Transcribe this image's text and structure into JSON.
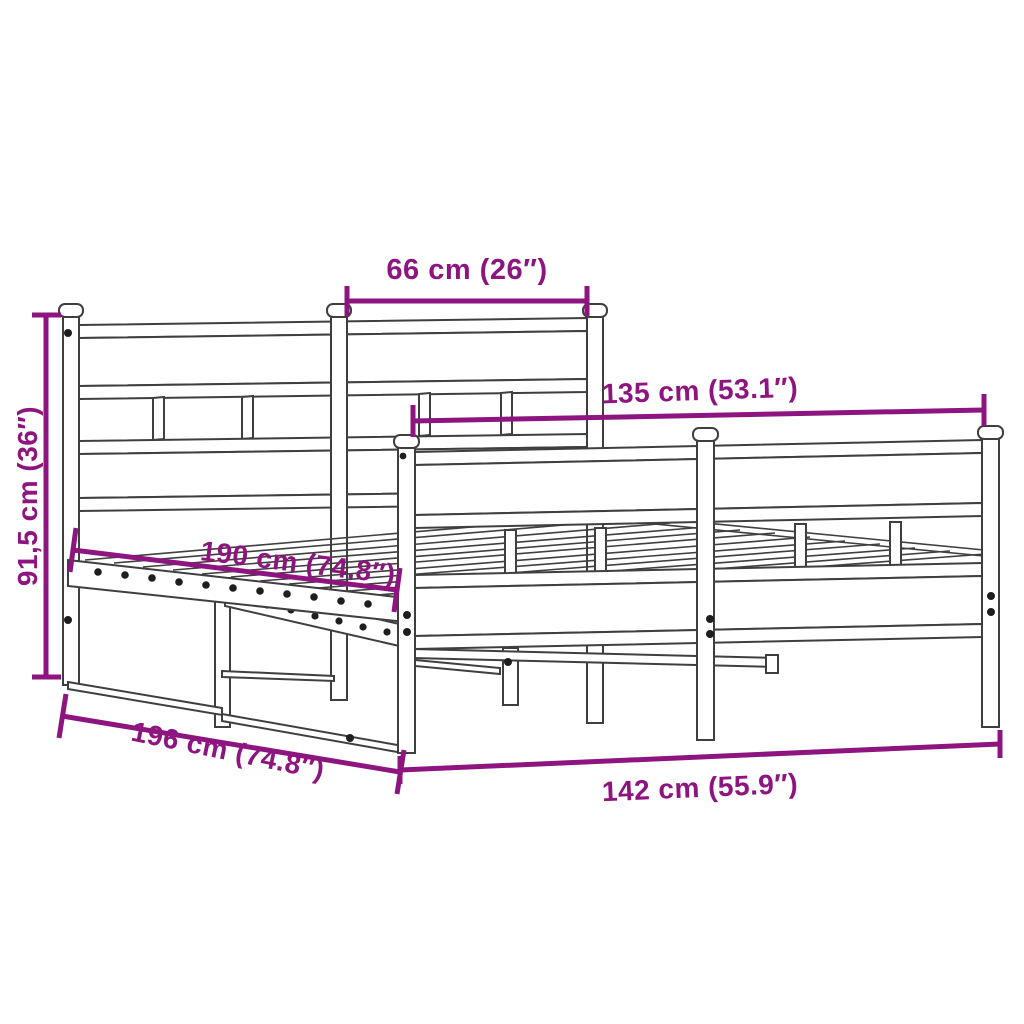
{
  "diagram": {
    "subject": "metal bed frame with headboard and footboard",
    "background": "#FFFFFF",
    "colors": {
      "dimension_accent": "#8E1480",
      "frame_outline": "#3F3F3F"
    },
    "dimensions": [
      {
        "id": "headboard-inner-span",
        "label": "66 cm (26″)"
      },
      {
        "id": "footboard-inner-width",
        "label": "135 cm (53.1″)"
      },
      {
        "id": "frame-height",
        "label": "91,5 cm (36″)"
      },
      {
        "id": "inner-length",
        "label": "190 cm (74.8″)"
      },
      {
        "id": "overall-length",
        "label": "196 cm (74.8″)"
      },
      {
        "id": "overall-width",
        "label": "142 cm (55.9″)"
      }
    ]
  }
}
